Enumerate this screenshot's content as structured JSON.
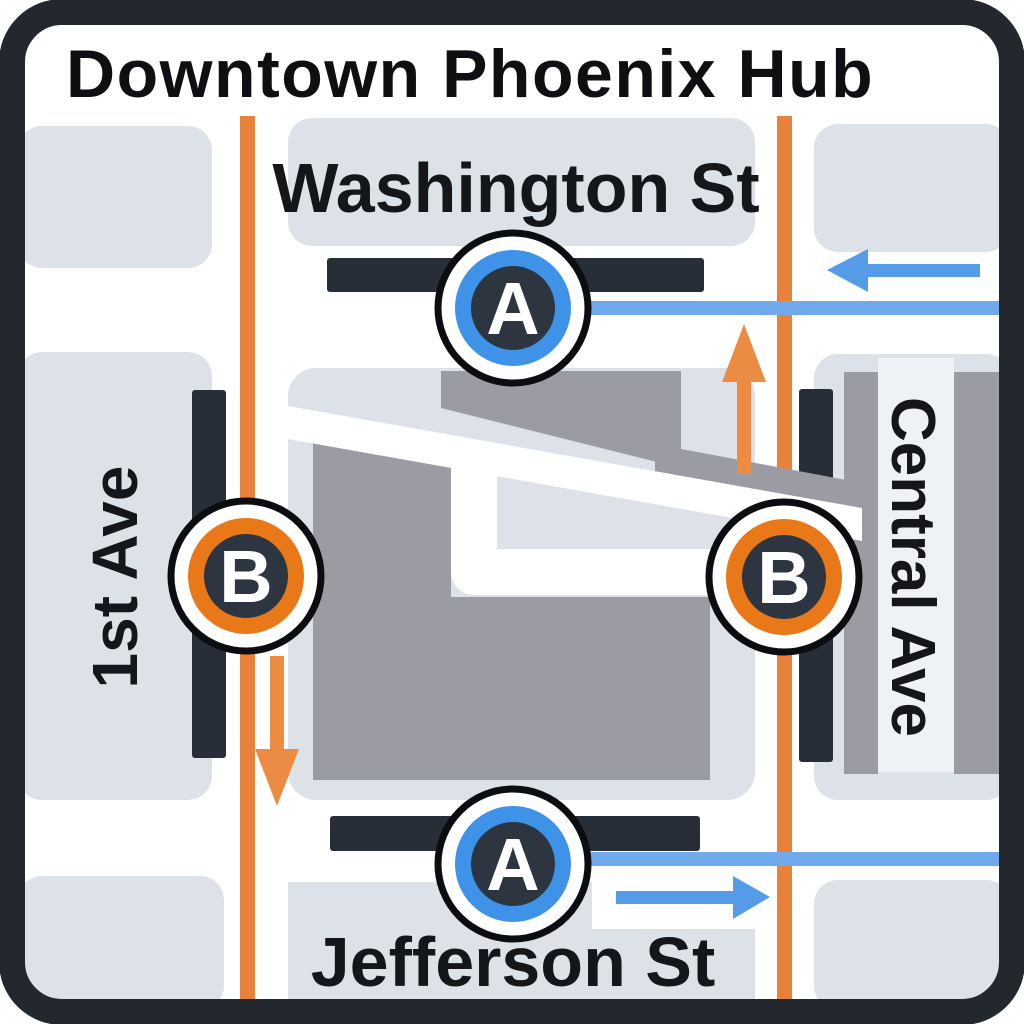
{
  "title": "Downtown Phoenix Hub",
  "streets": {
    "washington": "Washington St",
    "jefferson": "Jefferson St",
    "first_ave": "1st Ave",
    "central_ave": "Central Ave"
  },
  "lines": {
    "a": {
      "name": "A",
      "color": "#70a9ec",
      "ring_color": "#3e92e8",
      "arrow_color": "#549be8"
    },
    "b": {
      "name": "B",
      "color": "#e8823a",
      "ring_color": "#e87818",
      "arrow_color": "#ec8c42"
    }
  },
  "stations": [
    {
      "id": "a-north",
      "letter": "A",
      "line": "A",
      "street": "Washington St"
    },
    {
      "id": "b-west",
      "letter": "B",
      "line": "B",
      "street": "1st Ave"
    },
    {
      "id": "b-east",
      "letter": "B",
      "line": "B",
      "street": "Central Ave"
    },
    {
      "id": "a-south",
      "letter": "A",
      "line": "A",
      "street": "Jefferson St"
    }
  ],
  "arrows": [
    {
      "id": "line-a-north-arrow",
      "direction": "left"
    },
    {
      "id": "line-b-east-arrow",
      "direction": "up"
    },
    {
      "id": "line-b-west-arrow",
      "direction": "down"
    },
    {
      "id": "line-a-south-arrow",
      "direction": "right"
    }
  ],
  "colors": {
    "frame": "#23272e",
    "background": "#ffffff",
    "city_block": "#dce2e8",
    "building": "#9b9ba3",
    "platform": "#272e37",
    "label": "#141619"
  }
}
